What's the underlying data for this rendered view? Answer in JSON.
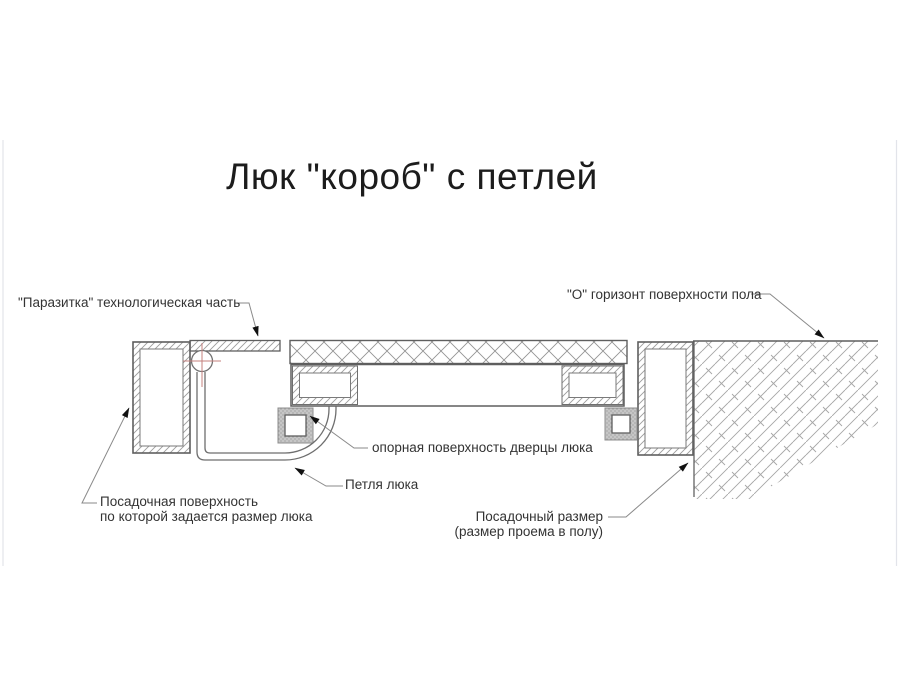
{
  "page": {
    "title": "Люк \"короб\" с петлей"
  },
  "labels": {
    "parasitka": "\"Паразитка\" технологическая часть",
    "o_horizon": "\"О\" горизонт поверхности пола",
    "opornaya": "опорная поверхность дверцы люка",
    "petlya": "Петля люка",
    "posad_left_line1": "Посадочная поверхность",
    "posad_left_line2": "по которой задается размер люка",
    "posad_right_line1": "Посадочный размер",
    "posad_right_line2": "(размер проема в полу)"
  },
  "colors": {
    "background": "#ffffff",
    "outline_gray": "#5f5f5f",
    "hatch_gray": "#9c9c9c",
    "concrete_hatch_gray": "#a6a6a6",
    "leader_gray": "#8a8a8a",
    "arrow_black": "#111111",
    "centerline_red": "#c4807e",
    "hinge_block_fill": "#c6c6c6",
    "text_color": "#333333"
  },
  "icons": {
    "hinge_pivot": "hinge-pivot-circle",
    "leader_arrow": "leader-arrowhead"
  }
}
